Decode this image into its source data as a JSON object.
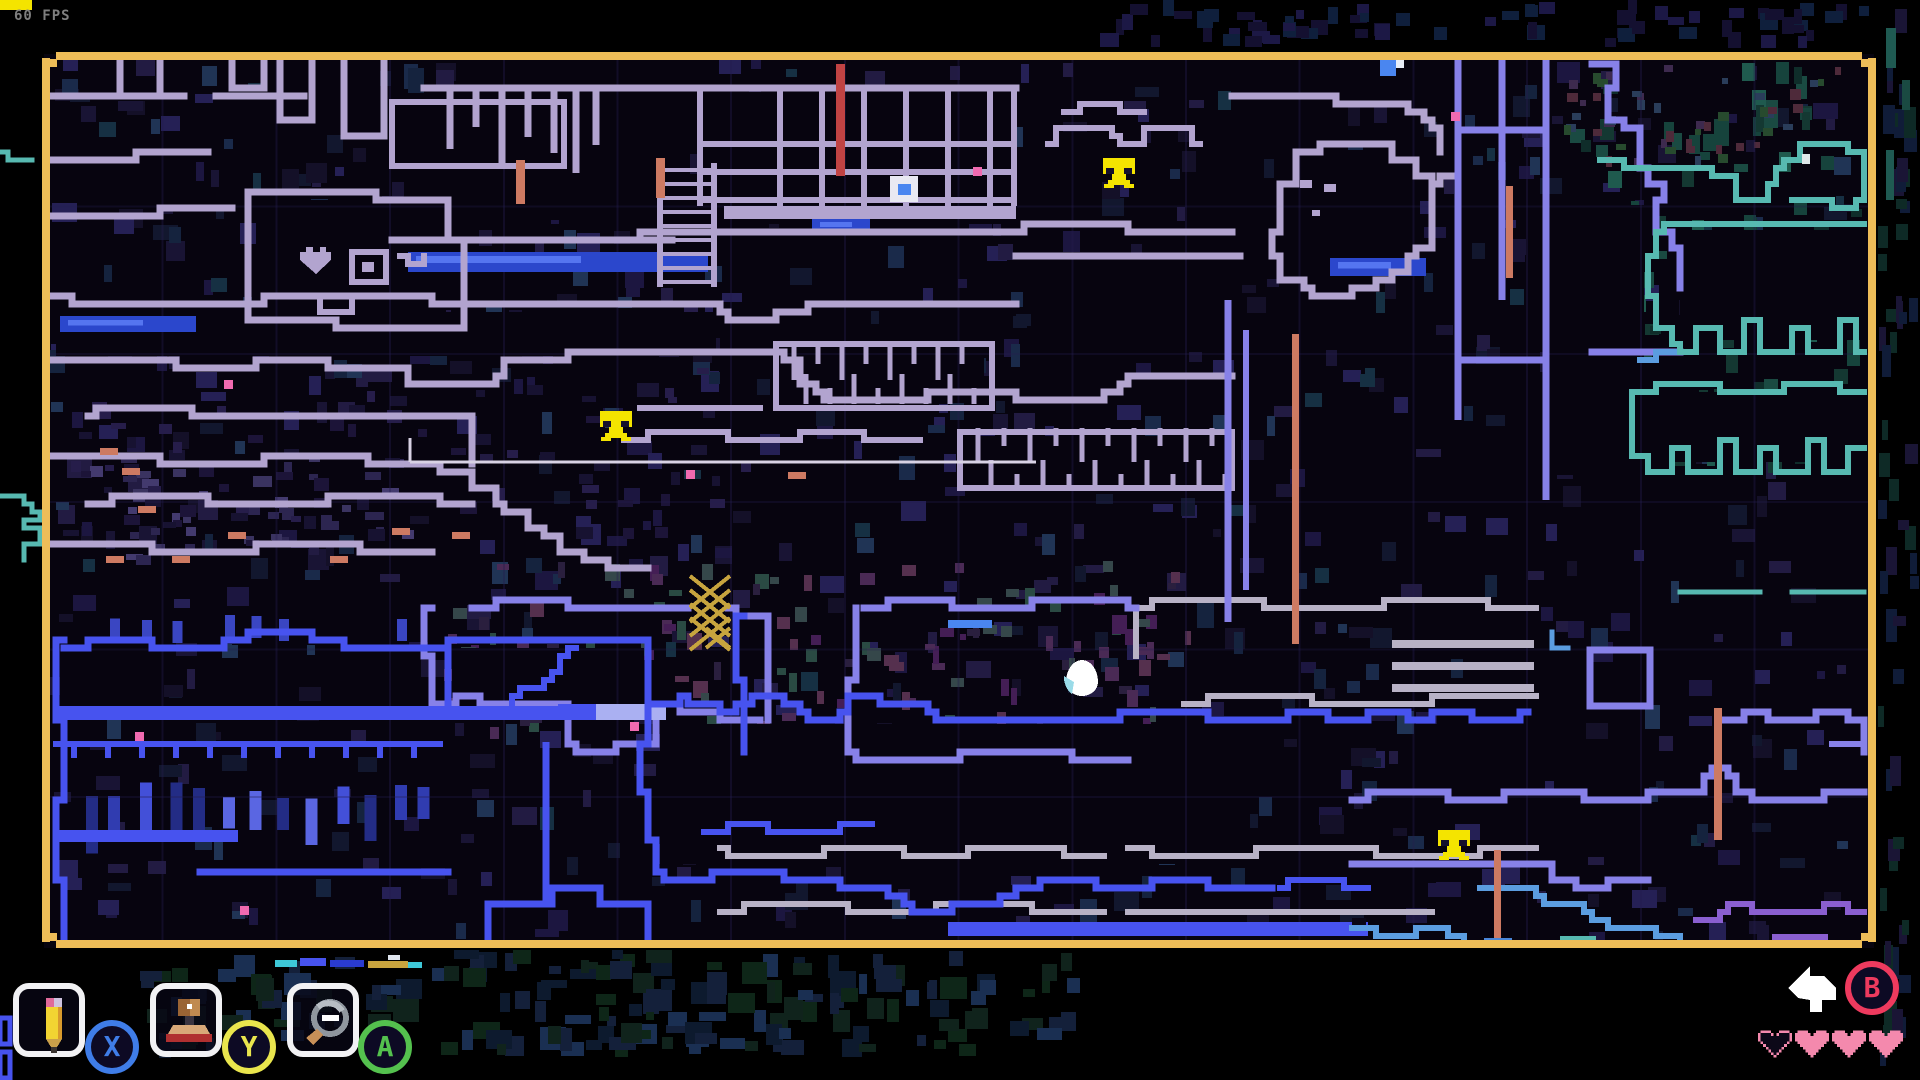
{
  "app": {
    "fps_label": "60 FPS"
  },
  "map": {
    "border_color": "#eebd58",
    "background": "#07040f",
    "markers": {
      "save_phones": [
        {
          "x": 1103,
          "y": 158
        },
        {
          "x": 600,
          "y": 411
        },
        {
          "x": 1438,
          "y": 830
        }
      ],
      "player_egg": {
        "x": 1082,
        "y": 674
      },
      "map_pin": {
        "x": 890,
        "y": 176
      }
    }
  },
  "toolbar": {
    "tools": [
      {
        "name": "pencil",
        "badge_letter": "X",
        "badge_color": "#3f7de8"
      },
      {
        "name": "stamp",
        "badge_letter": "Y",
        "badge_color": "#e9e54d"
      },
      {
        "name": "zoom-out",
        "badge_letter": "A",
        "badge_color": "#54c14e"
      }
    ]
  },
  "actions": {
    "undo": {
      "badge_letter": "B",
      "badge_color": "#ee3a5e"
    }
  },
  "status": {
    "hearts": {
      "total": 4,
      "filled": 3,
      "empty": 1,
      "color": "#f489ad"
    }
  },
  "palette": {
    "wall_lavender": "#b2a4cf",
    "wall_periwinkle": "#8781e8",
    "wall_blue": "#4753ef",
    "wall_lightblue": "#5b9de0",
    "wall_teal": "#57b9b1",
    "wall_gray": "#b8b2c6",
    "wall_purple": "#8a5fd0",
    "accent_red": "#c04343",
    "accent_salmon": "#cd7a62",
    "accent_pink": "#f06ab0",
    "phone_yellow": "#f4e400",
    "water_blue": "#3050d8",
    "gold": "#c7a43e"
  }
}
